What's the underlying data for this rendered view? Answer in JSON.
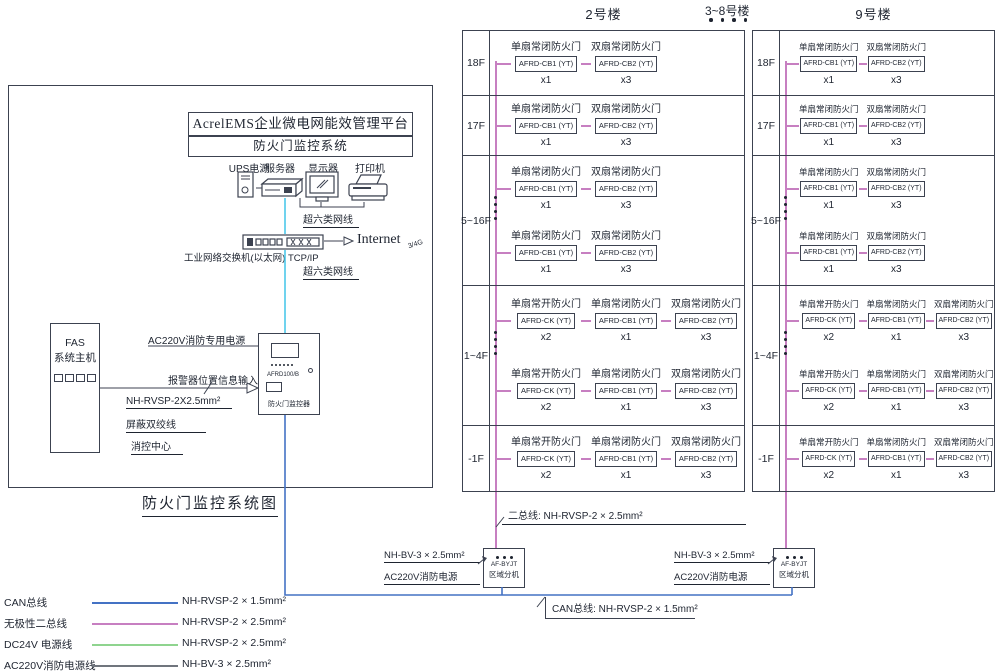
{
  "diagram_title": "防火门监控系统图",
  "platform": {
    "line1": "AcrelEMS企业微电网能效管理平台",
    "line2": "防火门监控系统"
  },
  "equipment": [
    {
      "label": "UPS电源"
    },
    {
      "label": "服务器"
    },
    {
      "label": "显示器"
    },
    {
      "label": "打印机"
    }
  ],
  "network": {
    "cat6_label": "超六类网线",
    "switch_label": "工业网络交换机(以太网) TCP/IP",
    "internet_label": "Internet",
    "internet_sub": "3/4G"
  },
  "fas_host": {
    "line1": "FAS",
    "line2": "系统主机"
  },
  "monitor_device": {
    "model": "AFRD100/B",
    "name": "防火门监控器"
  },
  "left_labels": {
    "ac220_dedicated": "AC220V消防专用电源",
    "alarm_input": "报警器位置信息输入",
    "shield_spec": "NH-RVSP-2X2.5mm²",
    "shield_name": "屏蔽双绞线",
    "control_center": "消控中心"
  },
  "between_buildings": "3~8号楼",
  "buildings": [
    {
      "name": "2号楼"
    },
    {
      "name": "9号楼"
    }
  ],
  "devices": {
    "ck": {
      "type": "单扇常开防火门",
      "model": "AFRD-CK (YT)",
      "qty": "x2"
    },
    "cb1": {
      "type": "单扇常闭防火门",
      "model": "AFRD-CB1 (YT)",
      "qty": "x1"
    },
    "cb2": {
      "type": "双扇常闭防火门",
      "model": "AFRD-CB2 (YT)",
      "qty": "x3"
    }
  },
  "floors": [
    {
      "label": "18F",
      "groups": [
        [
          "cb1",
          "cb2"
        ]
      ]
    },
    {
      "label": "17F",
      "groups": [
        [
          "cb1",
          "cb2"
        ]
      ]
    },
    {
      "label": "5~16F",
      "groups": [
        [
          "cb1",
          "cb2"
        ],
        [
          "cb1",
          "cb2"
        ]
      ],
      "dots": true
    },
    {
      "label": "1~4F",
      "groups": [
        [
          "ck",
          "cb1",
          "cb2"
        ],
        [
          "ck",
          "cb1",
          "cb2"
        ]
      ],
      "dots": true
    },
    {
      "label": "-1F",
      "groups": [
        [
          "ck",
          "cb1",
          "cb2"
        ]
      ]
    }
  ],
  "extension": {
    "model": "AF-BYJT",
    "name": "区域分机",
    "power_spec": "NH-BV-3 × 2.5mm²",
    "power_name": "AC220V消防电源"
  },
  "bus_labels": {
    "two_bus": "二总线: NH-RVSP-2 × 2.5mm²",
    "can_bus": "CAN总线: NH-RVSP-2 × 1.5mm²"
  },
  "legend": [
    {
      "name": "CAN总线",
      "color": "#4472c4",
      "spec": "NH-RVSP-2 × 1.5mm²"
    },
    {
      "name": "无极性二总线",
      "color": "#c77fc1",
      "spec": "NH-RVSP-2 × 2.5mm²"
    },
    {
      "name": "DC24V 电源线",
      "color": "#8fd48f",
      "spec": "NH-RVSP-2 × 2.5mm²"
    },
    {
      "name": "AC220V消防电源线",
      "color": "#70757d",
      "spec": "NH-BV-3 × 2.5mm²"
    }
  ],
  "colors": {
    "two_bus": "#c77fc1",
    "can_bus": "#4472c4",
    "cat6": "#4cc8ea"
  }
}
